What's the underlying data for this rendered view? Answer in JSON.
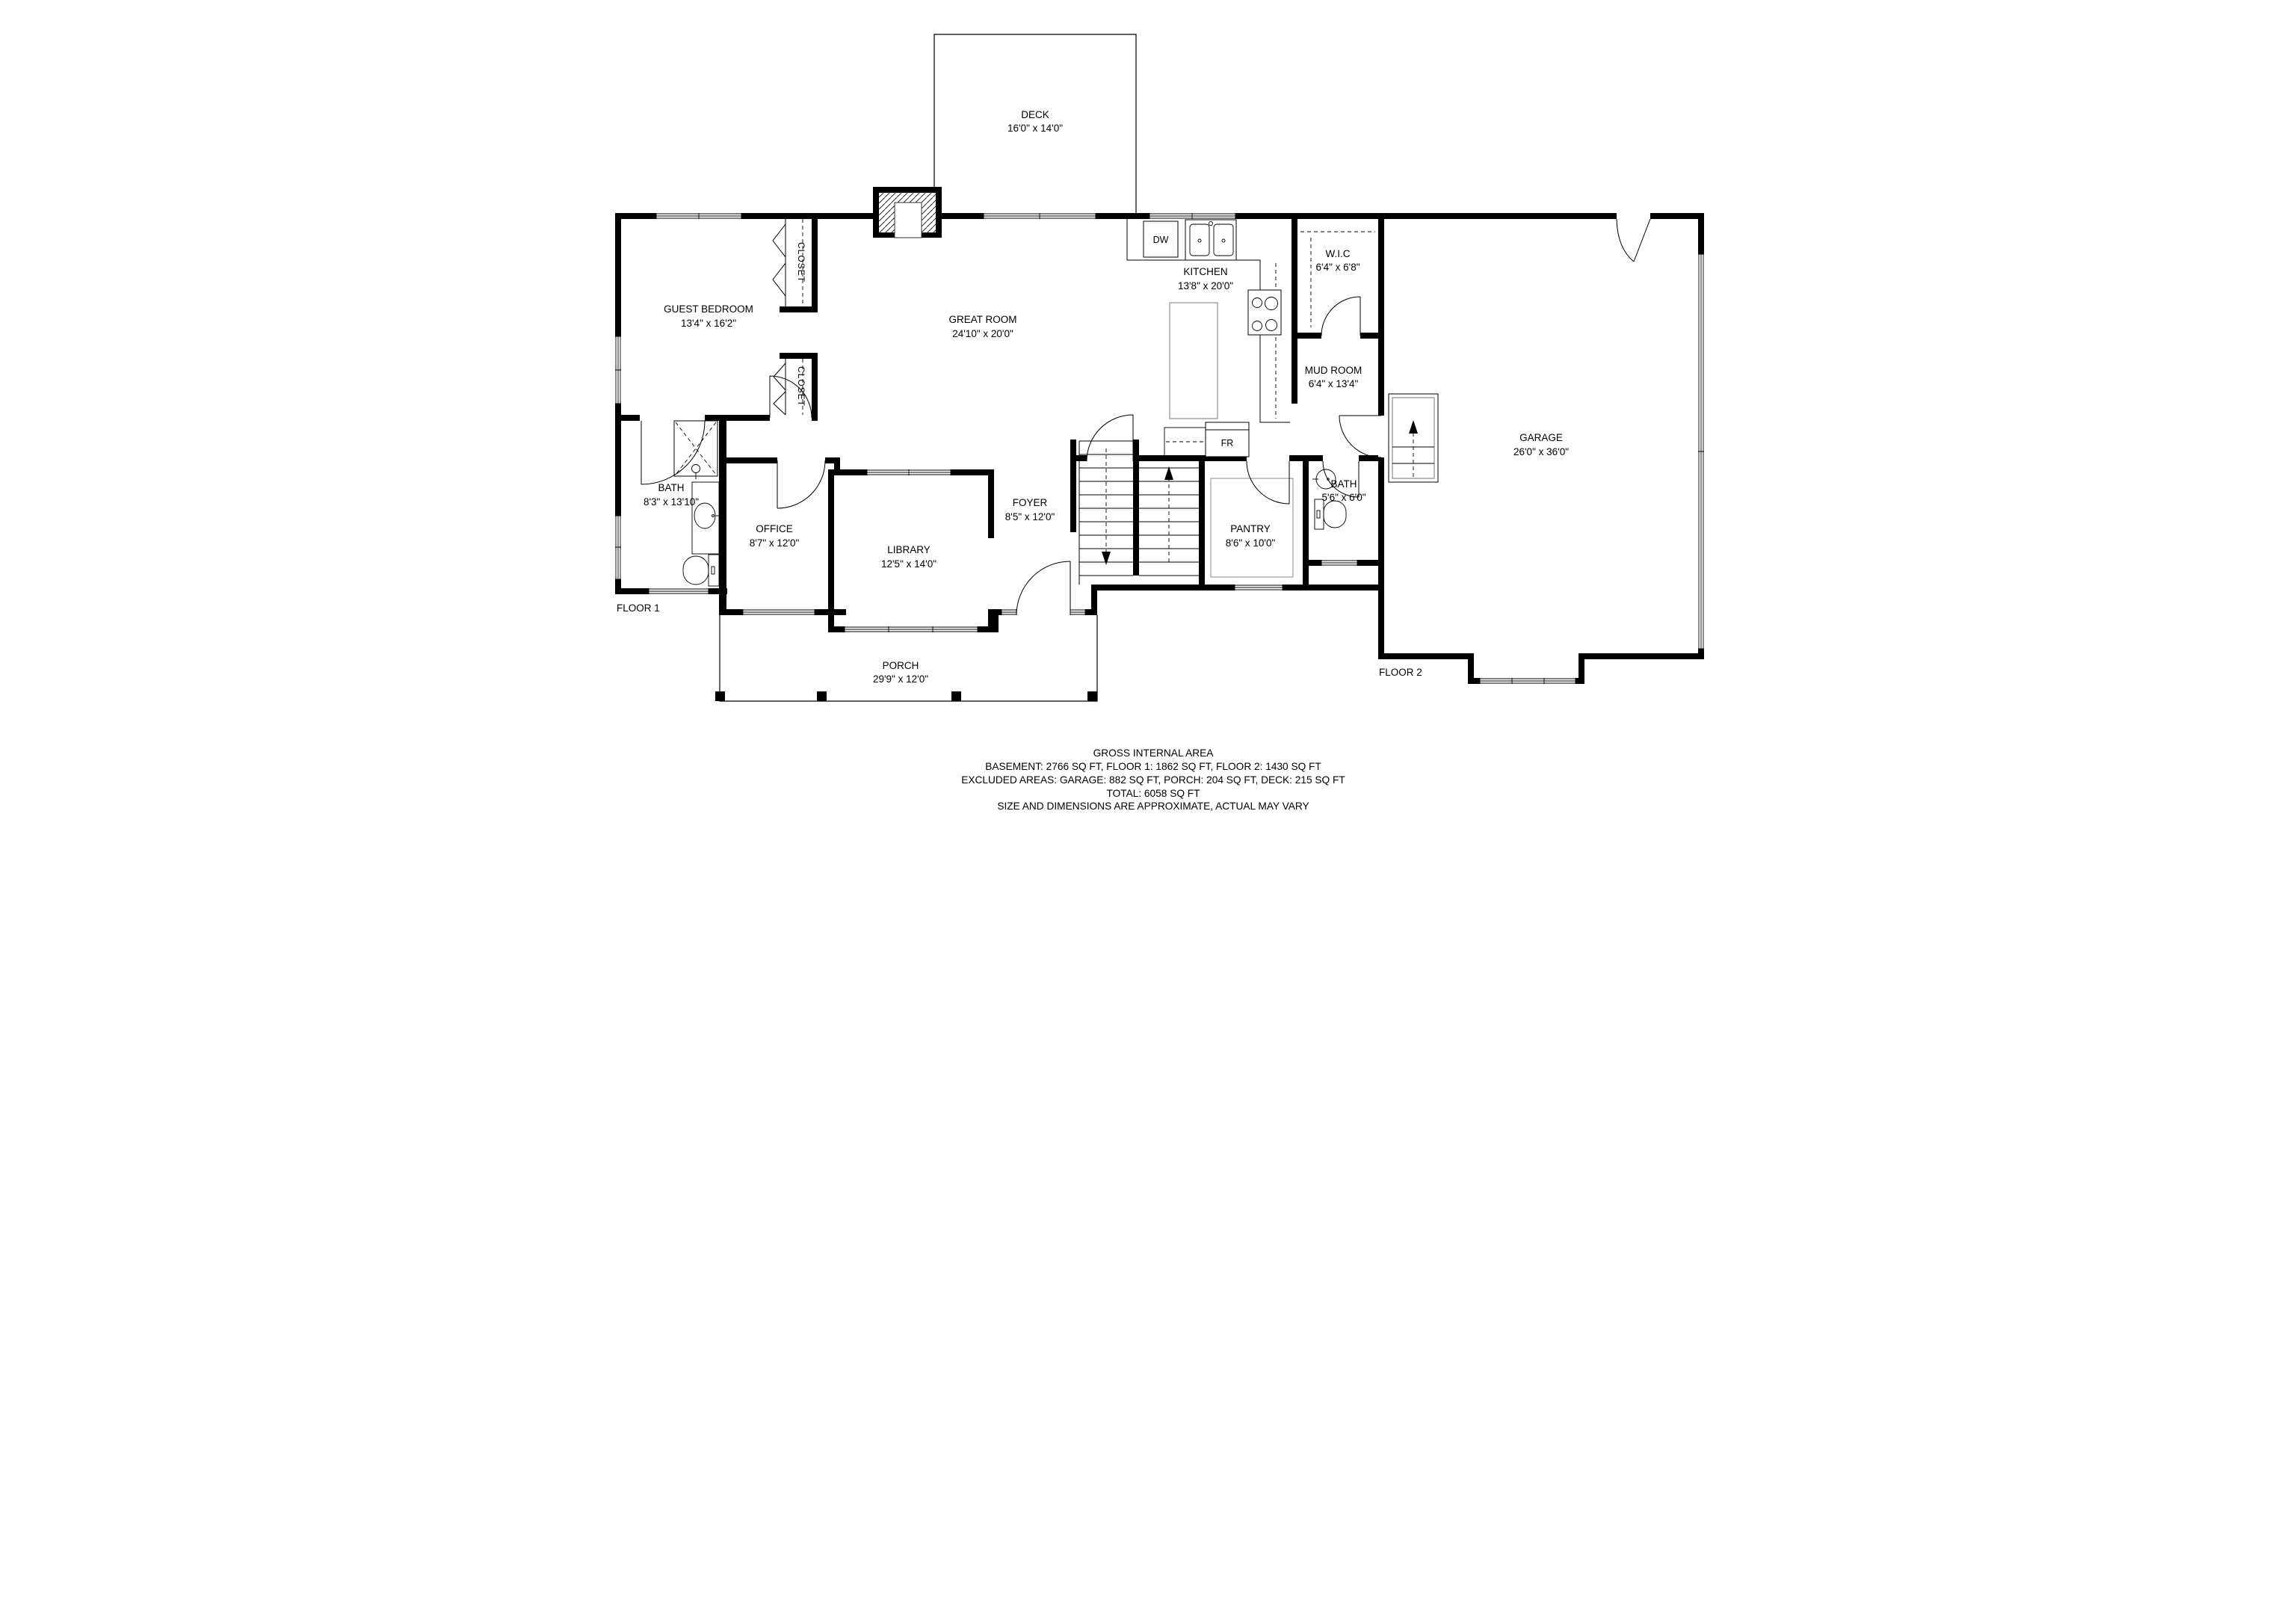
{
  "colors": {
    "wall": "#000000",
    "text": "#000000",
    "muted": "#7c7c7c"
  },
  "plan": {
    "floor_labels": {
      "floor1": "FLOOR 1",
      "floor2": "FLOOR 2"
    },
    "rooms": {
      "deck": {
        "name": "DECK",
        "dims": "16'0\" x 14'0\""
      },
      "great_room": {
        "name": "GREAT ROOM",
        "dims": "24'10\" x 20'0\""
      },
      "kitchen": {
        "name": "KITCHEN",
        "dims": "13'8\" x 20'0\""
      },
      "wic": {
        "name": "W.I.C",
        "dims": "6'4\" x 6'8\""
      },
      "mud_room": {
        "name": "MUD ROOM",
        "dims": "6'4\" x 13'4\""
      },
      "garage": {
        "name": "GARAGE",
        "dims": "26'0\" x 36'0\""
      },
      "guest_bedroom": {
        "name": "GUEST BEDROOM",
        "dims": "13'4\" x 16'2\""
      },
      "bath1": {
        "name": "BATH",
        "dims": "8'3\" x 13'10\""
      },
      "office": {
        "name": "OFFICE",
        "dims": "8'7\" x 12'0\""
      },
      "library": {
        "name": "LIBRARY",
        "dims": "12'5\" x 14'0\""
      },
      "foyer": {
        "name": "FOYER",
        "dims": "8'5\" x 12'0\""
      },
      "pantry": {
        "name": "PANTRY",
        "dims": "8'6\" x 10'0\""
      },
      "bath2": {
        "name": "BATH",
        "dims": "5'6\" x 6'0\""
      },
      "closet_upper": {
        "name": "CLOSET"
      },
      "closet_lower": {
        "name": "CLOSET"
      },
      "porch": {
        "name": "PORCH",
        "dims": "29'9\" x 12'0\""
      }
    },
    "appliances": {
      "dishwasher": "DW",
      "fridge": "FR"
    },
    "summary": {
      "title": "GROSS INTERNAL AREA",
      "areas_line": "BASEMENT: 2766 SQ FT, FLOOR 1: 1862 SQ FT, FLOOR 2: 1430 SQ FT",
      "excluded_line": "EXCLUDED AREAS: GARAGE: 882 SQ FT, PORCH: 204 SQ FT, DECK: 215 SQ FT",
      "total_line": "TOTAL: 6058 SQ FT",
      "disclaimer": "SIZE AND DIMENSIONS ARE APPROXIMATE, ACTUAL MAY VARY"
    }
  }
}
